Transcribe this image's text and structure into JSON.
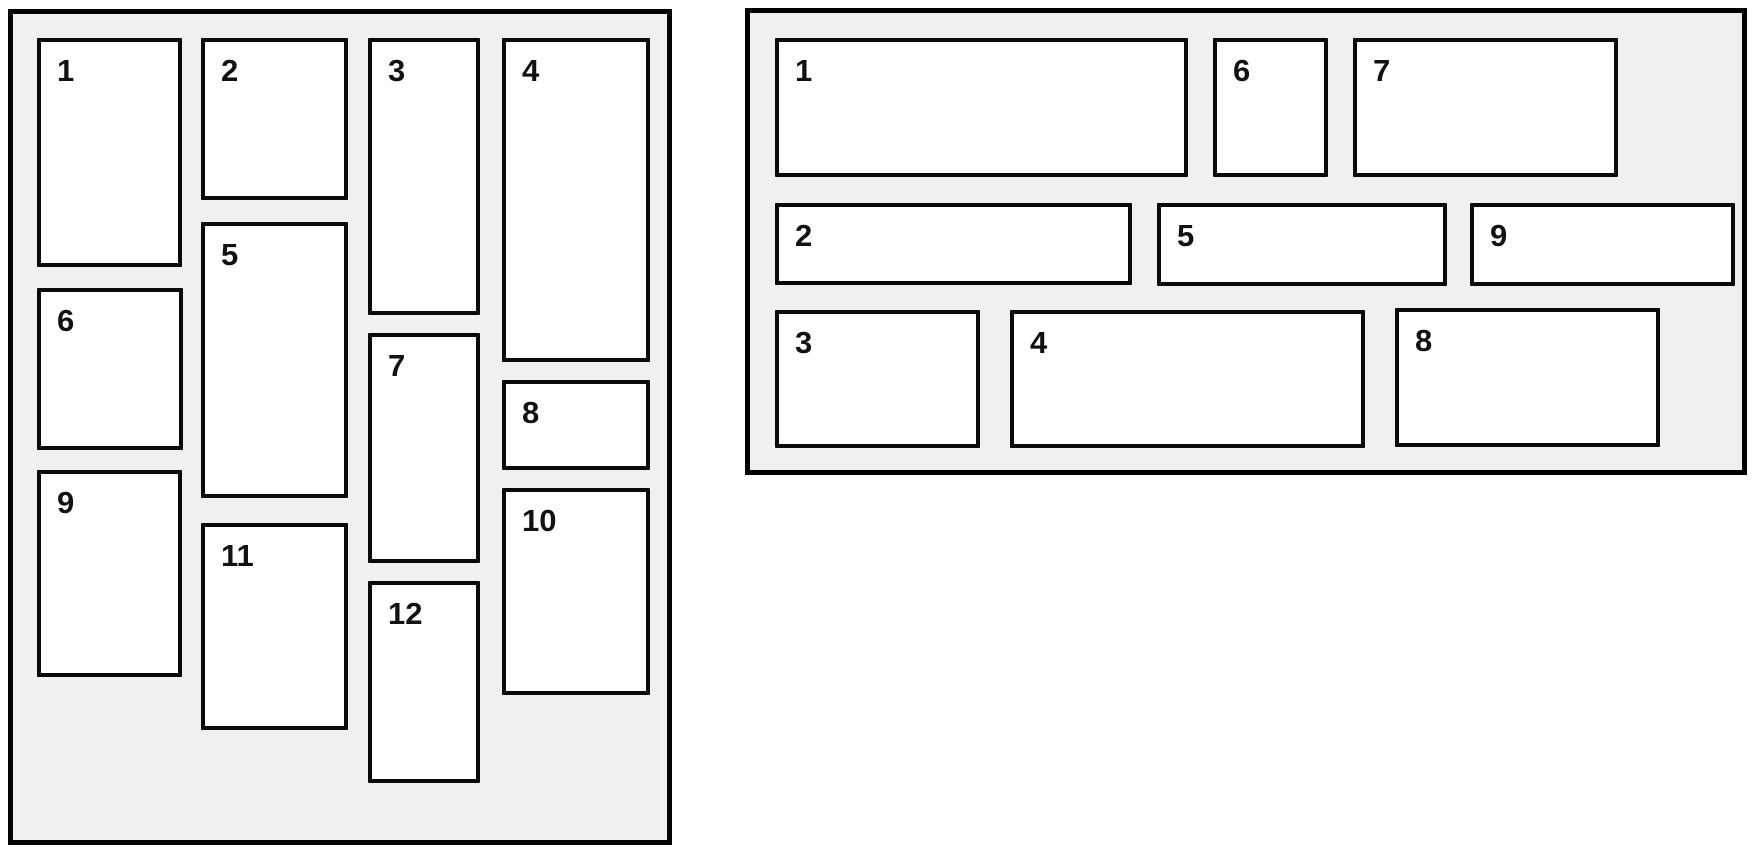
{
  "canvas": {
    "width": 1755,
    "height": 852,
    "background": "#ffffff"
  },
  "styles": {
    "panel_fill": "#f0f0f0",
    "panel_border": "#000000",
    "box_fill": "#ffffff",
    "box_border": "#0a0a0a",
    "label_color": "#111111"
  },
  "panels": [
    {
      "name": "masonry-columns-panel",
      "x": 8,
      "y": 9,
      "width": 664,
      "height": 836,
      "boxes": [
        {
          "label": "1",
          "x": 24,
          "y": 24,
          "w": 145,
          "h": 229
        },
        {
          "label": "2",
          "x": 188,
          "y": 24,
          "w": 147,
          "h": 162
        },
        {
          "label": "3",
          "x": 355,
          "y": 24,
          "w": 112,
          "h": 277
        },
        {
          "label": "4",
          "x": 489,
          "y": 24,
          "w": 148,
          "h": 324
        },
        {
          "label": "5",
          "x": 188,
          "y": 208,
          "w": 147,
          "h": 276
        },
        {
          "label": "6",
          "x": 24,
          "y": 274,
          "w": 146,
          "h": 162
        },
        {
          "label": "7",
          "x": 355,
          "y": 319,
          "w": 112,
          "h": 230
        },
        {
          "label": "8",
          "x": 489,
          "y": 366,
          "w": 148,
          "h": 90
        },
        {
          "label": "9",
          "x": 24,
          "y": 456,
          "w": 145,
          "h": 207
        },
        {
          "label": "10",
          "x": 489,
          "y": 474,
          "w": 148,
          "h": 207
        },
        {
          "label": "11",
          "x": 188,
          "y": 509,
          "w": 147,
          "h": 207
        },
        {
          "label": "12",
          "x": 355,
          "y": 567,
          "w": 112,
          "h": 202
        }
      ]
    },
    {
      "name": "rows-panel",
      "x": 745,
      "y": 8,
      "width": 1002,
      "height": 467,
      "boxes": [
        {
          "label": "1",
          "x": 25,
          "y": 25,
          "w": 413,
          "h": 139
        },
        {
          "label": "6",
          "x": 463,
          "y": 25,
          "w": 115,
          "h": 139
        },
        {
          "label": "7",
          "x": 603,
          "y": 25,
          "w": 265,
          "h": 139
        },
        {
          "label": "2",
          "x": 25,
          "y": 190,
          "w": 357,
          "h": 82
        },
        {
          "label": "5",
          "x": 407,
          "y": 190,
          "w": 290,
          "h": 83
        },
        {
          "label": "9",
          "x": 720,
          "y": 190,
          "w": 265,
          "h": 83
        },
        {
          "label": "3",
          "x": 25,
          "y": 297,
          "w": 205,
          "h": 138
        },
        {
          "label": "4",
          "x": 260,
          "y": 297,
          "w": 355,
          "h": 138
        },
        {
          "label": "8",
          "x": 645,
          "y": 295,
          "w": 265,
          "h": 139
        }
      ]
    }
  ]
}
